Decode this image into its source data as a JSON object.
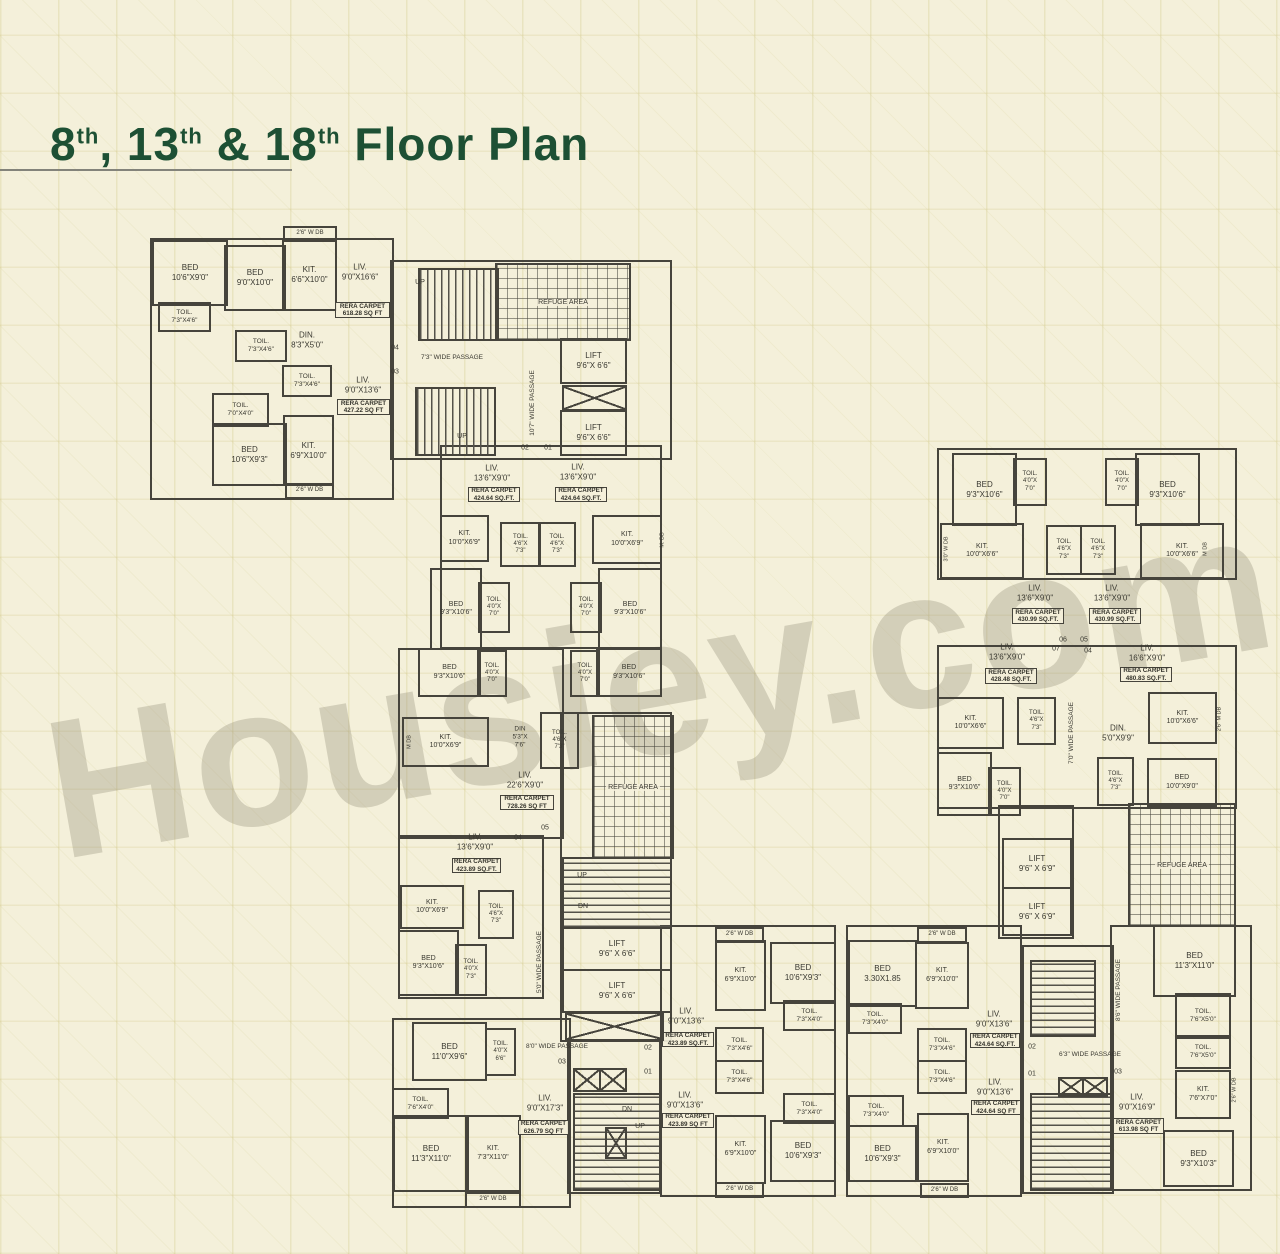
{
  "title": {
    "segments": [
      {
        "t": "8",
        "sup": false
      },
      {
        "t": "th",
        "sup": true
      },
      {
        "t": ", 13",
        "sup": false
      },
      {
        "t": "th",
        "sup": true
      },
      {
        "t": " & 18",
        "sup": false
      },
      {
        "t": "th",
        "sup": true
      },
      {
        "t": " Floor Plan",
        "sup": false
      }
    ],
    "color": "#1d5034"
  },
  "watermark": "Housiey.com",
  "plan": {
    "wall_color": "#46443c",
    "background_color": "#f4f0da",
    "outlines": [
      [
        150,
        238,
        240,
        258
      ],
      [
        390,
        260,
        278,
        196
      ],
      [
        440,
        445,
        218,
        200
      ],
      [
        398,
        648,
        162,
        187
      ],
      [
        560,
        712,
        108,
        326
      ],
      [
        398,
        835,
        142,
        160
      ],
      [
        392,
        1018,
        175,
        186
      ],
      [
        567,
        1040,
        90,
        150
      ],
      [
        660,
        925,
        172,
        268
      ],
      [
        846,
        925,
        172,
        268
      ],
      [
        937,
        448,
        296,
        128
      ],
      [
        937,
        645,
        296,
        160
      ],
      [
        998,
        805,
        72,
        130
      ],
      [
        1110,
        925,
        138,
        262
      ],
      [
        1022,
        945,
        88,
        245
      ]
    ],
    "rooms": [
      [
        152,
        240,
        72,
        62,
        "BED|10'6\"X9'0\""
      ],
      [
        224,
        245,
        58,
        62,
        "BED|9'0\"X10'0\""
      ],
      [
        282,
        238,
        51,
        69,
        "KIT.|6'6\"X10'0\""
      ],
      [
        283,
        226,
        50,
        12,
        "2'6\" W DB",
        6
      ],
      [
        158,
        302,
        49,
        26,
        "TOIL.|7'3\"X4'6\"",
        6.5
      ],
      [
        235,
        330,
        48,
        28,
        "TOIL.|7'3\"X4'6\"",
        6.5
      ],
      [
        282,
        365,
        46,
        28,
        "TOIL.|7'3\"X4'6\"",
        6.5
      ],
      [
        212,
        393,
        53,
        30,
        "TOIL.|7'0\"X4'0\"",
        6.5
      ],
      [
        212,
        423,
        71,
        59,
        "BED|10'6\"X9'3\""
      ],
      [
        283,
        415,
        47,
        67,
        "KIT.|6'9\"X10'0\""
      ],
      [
        285,
        483,
        45,
        12,
        "2'6\" W DB",
        6
      ],
      [
        440,
        515,
        45,
        43,
        "KIT.|10'0\"X6'9\"",
        7
      ],
      [
        500,
        522,
        37,
        41,
        "TOIL.|4'6\"X|7'3\"",
        6
      ],
      [
        538,
        522,
        34,
        41,
        "TOIL.|4'6\"X|7'3\"",
        6
      ],
      [
        592,
        515,
        66,
        45,
        "KIT.|10'0\"X6'9\"",
        7
      ],
      [
        430,
        568,
        48,
        78,
        "BED|9'3\"X10'6\"",
        7
      ],
      [
        478,
        582,
        28,
        47,
        "TOIL.|4'0\"X|7'0\"",
        6
      ],
      [
        570,
        582,
        28,
        47,
        "TOIL.|4'0\"X|7'0\"",
        6
      ],
      [
        598,
        568,
        60,
        78,
        "BED|9'3\"X10'6\"",
        7
      ],
      [
        418,
        648,
        59,
        45,
        "BED|9'3\"X10'6\"",
        7
      ],
      [
        477,
        650,
        26,
        43,
        "TOIL.|4'0\"X|7'0\"",
        6
      ],
      [
        570,
        650,
        26,
        43,
        "TOIL.|4'0\"X|7'0\"",
        6
      ],
      [
        596,
        648,
        62,
        45,
        "BED|9'3\"X10'6\"",
        7
      ],
      [
        402,
        717,
        83,
        46,
        "KIT.|10'0\"X6'9\"",
        7
      ],
      [
        540,
        712,
        35,
        53,
        "TOIL.|4'6\"X|7'3\"",
        6
      ],
      [
        400,
        885,
        60,
        40,
        "KIT.|10'0\"X6'9\"",
        7
      ],
      [
        478,
        890,
        32,
        45,
        "TOIL.|4'6\"X|7'3\"",
        6
      ],
      [
        398,
        930,
        57,
        62,
        "BED|9'3\"X10'6\"",
        7
      ],
      [
        455,
        944,
        28,
        48,
        "TOIL.|4'0\"X|7'3\"",
        6
      ],
      [
        412,
        1022,
        71,
        55,
        "BED|11'0\"X9'6\""
      ],
      [
        485,
        1028,
        27,
        44,
        "TOIL.|4'0\"X|6'6\"",
        6
      ],
      [
        392,
        1088,
        53,
        27,
        "TOIL.|7'6\"X4'0\"",
        6.5
      ],
      [
        393,
        1115,
        72,
        73,
        "BED|11'3\"X11'0\""
      ],
      [
        465,
        1115,
        52,
        73,
        "KIT.|7'3\"X11'0\"",
        7
      ],
      [
        465,
        1192,
        52,
        12,
        "2'6\" W DB",
        6
      ],
      [
        715,
        927,
        45,
        12,
        "2'6\" W DB",
        6
      ],
      [
        715,
        940,
        47,
        67,
        "KIT.|6'9\"X10'0\"",
        7
      ],
      [
        770,
        942,
        62,
        58,
        "BED|10'6\"X9'3\""
      ],
      [
        783,
        1000,
        49,
        27,
        "TOIL.|7'3\"X4'0\"",
        6.5
      ],
      [
        715,
        1027,
        45,
        31,
        "TOIL.|7'3\"X4'6\"",
        6.5
      ],
      [
        715,
        1060,
        45,
        30,
        "TOIL.|7'3\"X4'6\"",
        6.5
      ],
      [
        783,
        1093,
        49,
        27,
        "TOIL.|7'3\"X4'0\"",
        6.5
      ],
      [
        715,
        1115,
        47,
        65,
        "KIT.|6'9\"X10'0\"",
        7
      ],
      [
        770,
        1120,
        62,
        58,
        "BED|10'6\"X9'3\""
      ],
      [
        715,
        1182,
        45,
        12,
        "2'6\" W DB",
        6
      ],
      [
        917,
        927,
        46,
        12,
        "2'6\" W DB",
        6
      ],
      [
        848,
        940,
        65,
        63,
        "BED|3.30X1.85"
      ],
      [
        915,
        942,
        50,
        63,
        "KIT.|6'9\"X10'0\"",
        7
      ],
      [
        848,
        1003,
        50,
        27,
        "TOIL.|7'3\"X4'0\"",
        6.5
      ],
      [
        917,
        1028,
        46,
        30,
        "TOIL.|7'3\"X4'6\"",
        6.5
      ],
      [
        917,
        1060,
        46,
        30,
        "TOIL.|7'3\"X4'6\"",
        6.5
      ],
      [
        848,
        1095,
        52,
        28,
        "TOIL.|7'3\"X4'0\"",
        6.5
      ],
      [
        848,
        1125,
        65,
        53,
        "BED|10'6\"X9'3\""
      ],
      [
        917,
        1113,
        48,
        65,
        "KIT.|6'9\"X10'0\"",
        7
      ],
      [
        920,
        1183,
        45,
        11,
        "2'6\" W DB",
        6
      ],
      [
        952,
        453,
        61,
        69,
        "BED|9'3\"X10'6\""
      ],
      [
        1013,
        458,
        30,
        44,
        "TOIL.|4'0\"X|7'0\"",
        6
      ],
      [
        1105,
        458,
        30,
        44,
        "TOIL.|4'0\"X|7'0\"",
        6
      ],
      [
        1135,
        453,
        61,
        69,
        "BED|9'3\"X10'6\""
      ],
      [
        940,
        523,
        80,
        52,
        "KIT.|10'0\"X6'6\"",
        7
      ],
      [
        1046,
        525,
        32,
        46,
        "TOIL.|4'6\"X|7'3\"",
        6
      ],
      [
        1080,
        525,
        32,
        46,
        "TOIL.|4'6\"X|7'3\"",
        6
      ],
      [
        1140,
        523,
        80,
        52,
        "KIT.|10'0\"X6'6\"",
        7
      ],
      [
        937,
        697,
        63,
        48,
        "KIT.|10'0\"X6'6\"",
        7
      ],
      [
        1017,
        697,
        35,
        44,
        "TOIL.|4'6\"X|7'3\"",
        6
      ],
      [
        1148,
        692,
        65,
        48,
        "KIT.|10'0\"X6'6\"",
        7
      ],
      [
        937,
        752,
        51,
        60,
        "BED|9'3\"X10'6\"",
        7
      ],
      [
        988,
        767,
        29,
        45,
        "TOIL.|4'0\"X|7'0\"",
        6
      ],
      [
        1097,
        757,
        33,
        45,
        "TOIL.|4'6\"X|7'3\"",
        6
      ],
      [
        1147,
        758,
        66,
        45,
        "BED|10'0\"X9'0\"",
        7
      ],
      [
        1153,
        925,
        79,
        68,
        "BED|11'3\"X11'0\""
      ],
      [
        1175,
        993,
        52,
        42,
        "TOIL.|7'6\"X5'0\"",
        6.5
      ],
      [
        1175,
        1035,
        52,
        30,
        "TOIL.|7'6\"X5'0\"",
        6.5
      ],
      [
        1175,
        1070,
        52,
        45,
        "KIT.|7'6\"X7'0\"",
        7
      ],
      [
        1163,
        1130,
        67,
        53,
        "BED|9'3\"X10'3\""
      ]
    ],
    "lifts": [
      [
        560,
        338,
        63,
        42,
        "LIFT|9'6\"X 6'6\""
      ],
      [
        560,
        410,
        63,
        42,
        "LIFT|9'6\"X 6'6\""
      ],
      [
        562,
        927,
        106,
        40,
        "LIFT|9'6\" X 6'6\""
      ],
      [
        562,
        969,
        106,
        40,
        "LIFT|9'6\" X 6'6\""
      ],
      [
        1002,
        838,
        66,
        47,
        "LIFT|9'6\" X 6'9\""
      ],
      [
        1002,
        887,
        66,
        45,
        "LIFT|9'6\" X 6'9\""
      ]
    ],
    "labels": [
      [
        360,
        272,
        "LIV.|9'0\"X16'6\"",
        "h",
        8
      ],
      [
        307,
        340,
        "DIN.|8'3\"X5'0\"",
        "h",
        8
      ],
      [
        363,
        385,
        "LIV.|9'0\"X13'6\"",
        "h",
        8
      ],
      [
        452,
        358,
        "7'3\"  WIDE PASSAGE",
        "h",
        6.5
      ],
      [
        533,
        403,
        "10'7\" WIDE PASSAGE",
        "v",
        6.5
      ],
      [
        420,
        283,
        "UP",
        "h",
        7
      ],
      [
        462,
        437,
        "UP",
        "h",
        7
      ],
      [
        492,
        473,
        "LIV.|13'6\"X9'0\"",
        "h",
        8
      ],
      [
        578,
        472,
        "LIV.|13'6\"X9'0\"",
        "h",
        8
      ],
      [
        520,
        737,
        "DIN|5'3\"X|7'6\"",
        "h",
        6.5
      ],
      [
        525,
        780,
        "LIV.|22'6\"X9'0\"",
        "h",
        8
      ],
      [
        475,
        842,
        "LIV.|13'6\"X9'0\"",
        "h",
        8
      ],
      [
        545,
        1103,
        "LIV.|9'0\"X17'3\"",
        "h",
        8
      ],
      [
        557,
        1047,
        "8'0\" WIDE PASSAGE",
        "h",
        6.5
      ],
      [
        540,
        962,
        "5'0\" WIDE PASSAGE",
        "v",
        6.5
      ],
      [
        582,
        876,
        "UP",
        "h",
        7
      ],
      [
        583,
        907,
        "DN",
        "h",
        7
      ],
      [
        627,
        1110,
        "DN",
        "h",
        7
      ],
      [
        640,
        1127,
        "UP",
        "h",
        7
      ],
      [
        686,
        1016,
        "LIV.|9'0\"X13'6\"",
        "h",
        8
      ],
      [
        685,
        1100,
        "LIV.|9'0\"X13'6\"",
        "h",
        8
      ],
      [
        994,
        1019,
        "LIV.|9'0\"X13'6\"",
        "h",
        8
      ],
      [
        995,
        1087,
        "LIV.|9'0\"X13'6\"",
        "h",
        8
      ],
      [
        1035,
        593,
        "LIV.|13'6\"X9'0\"",
        "h",
        8
      ],
      [
        1112,
        593,
        "LIV.|13'6\"X9'0\"",
        "h",
        8
      ],
      [
        1007,
        652,
        "LIV.|13'6\"X9'0\"",
        "h",
        8
      ],
      [
        1147,
        653,
        "LIV.|16'6\"X9'0\"",
        "h",
        8
      ],
      [
        1118,
        733,
        "DIN.|5'0\"X9'9\"",
        "h",
        8
      ],
      [
        1072,
        733,
        "7'0\" WIDE PASSAGE",
        "v",
        6.5
      ],
      [
        1119,
        990,
        "8'6\" WIDE PASSAGE",
        "v",
        6.5
      ],
      [
        1090,
        1055,
        "6'3\" WIDE PASSAGE",
        "h",
        6.5
      ],
      [
        1137,
        1102,
        "LIV.|9'0\"X16'9\"",
        "h",
        8
      ],
      [
        663,
        540,
        "M. DB",
        "v",
        5.5
      ],
      [
        410,
        742,
        "M DB",
        "v",
        5.5
      ],
      [
        947,
        549,
        "3'0\" W DB",
        "v",
        5.5
      ],
      [
        1206,
        549,
        "M DB",
        "v",
        5.5
      ],
      [
        1220,
        719,
        "2'6\" M DB",
        "v",
        5.5
      ],
      [
        1235,
        1090,
        "2'6\" W DB",
        "v",
        5.5
      ]
    ],
    "rera": [
      [
        335,
        302,
        53,
        14,
        "RERA CARPET|618.28 SQ FT"
      ],
      [
        337,
        399,
        51,
        14,
        "RERA CARPET|427.22 SQ FT"
      ],
      [
        468,
        487,
        50,
        13,
        "RERA CARPET|424.64 SQ.FT."
      ],
      [
        555,
        487,
        50,
        13,
        "RERA CARPET|424.64 SQ.FT."
      ],
      [
        500,
        795,
        52,
        13,
        "RERA CARPET|728.26 SQ FT"
      ],
      [
        452,
        858,
        47,
        13,
        "RERA CARPET|423.89 SQ.FT."
      ],
      [
        518,
        1120,
        49,
        13,
        "RERA CARPET|626.79 SQ FT"
      ],
      [
        662,
        1032,
        50,
        13,
        "RERA CARPET|423.89 SQ.FT."
      ],
      [
        662,
        1113,
        50,
        13,
        "RERA CARPET|423.89 SQ FT"
      ],
      [
        970,
        1033,
        48,
        13,
        "RERA CARPET|424.64 SQ.FT."
      ],
      [
        971,
        1100,
        48,
        13,
        "RERA CARPET|424.64 SQ FT"
      ],
      [
        1012,
        608,
        50,
        14,
        "RERA CARPET|430.99 SQ.FT."
      ],
      [
        1089,
        608,
        50,
        14,
        "RERA CARPET|430.99 SQ.FT."
      ],
      [
        985,
        668,
        50,
        14,
        "RERA CARPET|428.48 SQ.FT."
      ],
      [
        1120,
        667,
        50,
        13,
        "RERA CARPET|480.83 SQ.FT."
      ],
      [
        1113,
        1118,
        49,
        14,
        "RERA CARPET|613.98 SQ FT"
      ]
    ],
    "stairs": [
      [
        418,
        268,
        77,
        69,
        "v"
      ],
      [
        415,
        387,
        77,
        65,
        "v"
      ],
      [
        562,
        857,
        106,
        68,
        "h"
      ],
      [
        573,
        1093,
        84,
        94,
        "h"
      ],
      [
        1030,
        960,
        62,
        73,
        "h"
      ],
      [
        1030,
        1093,
        78,
        94,
        "h"
      ]
    ],
    "xboxes": [
      [
        562,
        385,
        61,
        22
      ],
      [
        565,
        1012,
        95,
        25
      ],
      [
        573,
        1068,
        24,
        20
      ],
      [
        599,
        1068,
        24,
        20
      ],
      [
        605,
        1127,
        18,
        28
      ],
      [
        1058,
        1077,
        22,
        16
      ],
      [
        1082,
        1077,
        22,
        16
      ]
    ],
    "refuges": [
      {
        "x": 495,
        "y": 263,
        "w": 132,
        "h": 74,
        "label": "REFUGE AREA"
      },
      {
        "x": 592,
        "y": 715,
        "w": 78,
        "h": 140,
        "label": "REFUGE AREA"
      },
      {
        "x": 1128,
        "y": 803,
        "w": 104,
        "h": 120,
        "label": "REFUGE AREA"
      }
    ],
    "units": [
      [
        395,
        348,
        "04"
      ],
      [
        395,
        372,
        "03"
      ],
      [
        525,
        448,
        "02"
      ],
      [
        548,
        448,
        "01"
      ],
      [
        545,
        828,
        "05"
      ],
      [
        518,
        838,
        "04"
      ],
      [
        1063,
        640,
        "06"
      ],
      [
        1084,
        640,
        "05"
      ],
      [
        1056,
        649,
        "07"
      ],
      [
        1088,
        651,
        "04"
      ],
      [
        562,
        1062,
        "03"
      ],
      [
        648,
        1048,
        "02"
      ],
      [
        648,
        1072,
        "01"
      ],
      [
        1032,
        1047,
        "02"
      ],
      [
        1032,
        1074,
        "01"
      ],
      [
        1118,
        1072,
        "03"
      ]
    ]
  }
}
